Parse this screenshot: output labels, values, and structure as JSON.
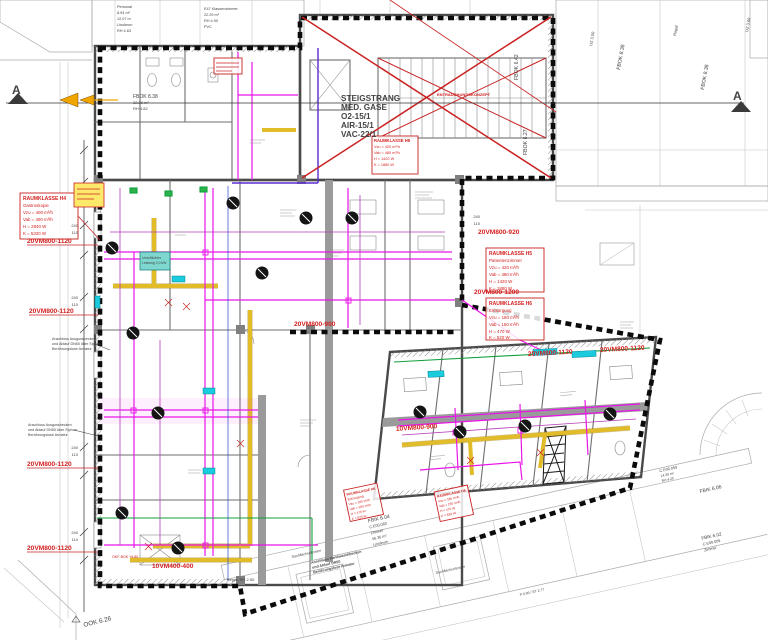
{
  "markers": {
    "section_left": "A",
    "section_right": "A"
  },
  "levels": {
    "ook": "OOK 6.26",
    "fbok_642": "FBOK 6.42",
    "fbok_627": "FBOK 6.27",
    "fbik_606": "FBIK 6.06",
    "fbok_838_b": "FBOK 8.38",
    "fbok_838_c": "FBOK 8.38"
  },
  "riser_note": {
    "l1": "STEIGSTRANG",
    "l2": "MED. GASE",
    "l3": "O2-15/1",
    "l4": "AIR-15/1",
    "l5": "VAC-22/1"
  },
  "crossed_note": "ENTRAUCHUNGSKONZEPT",
  "duct_labels": {
    "vm1": "20VM800-1120",
    "vm2": "20VM800-1120",
    "vm3": "20VM800-1120",
    "vm4": "20VM800-1120",
    "vm5": "20VM800-920",
    "vm6": "20VM800-1200",
    "vm7": "20VM800-900",
    "vm8": "20VM800-1120",
    "vm9": "20VM800-1120",
    "vm10": "10VM400-400",
    "vm11": "10VM800-900",
    "okf": "OKF-BOK +9.80"
  },
  "raumklasse_a": {
    "l1": "RAUMKLASSE H4",
    "l2": "Gastroskopie",
    "l3": "Vzu = 400 m³/h",
    "l4": "Vab = 400 m³/h",
    "l5": "H = 2840 W",
    "l6": "K = 5320 W"
  },
  "raumklasse_b": {
    "l1": "RAUMKLASSE H5",
    "l2": "Patientenzimmer",
    "l3": "Vzu = 420 m³/h",
    "l4": "Vab = 480 m³/h",
    "l5": "H = 1420 W",
    "l6": "K = 1880 W"
  },
  "raumklasse_c": {
    "l1": "RAUMKLASSE H6",
    "l2": "Entsorgung",
    "l3": "Vzu = 180 m³/h",
    "l4": "Vab = 150 m³/h",
    "l5": "H = 470 W",
    "l6": "K = 520 W"
  },
  "rooms": {
    "personal": {
      "l1": "Personal",
      "l2": "8.94 m²",
      "l3": "12.07 m",
      "l4": "Linoleum",
      "l5": "RH 4.63"
    },
    "klasse": {
      "l1": "E47 Klassenzimmer",
      "l2": "22.29 m²",
      "l3": "RH 4.90",
      "l4": "PVC"
    },
    "bath": {
      "l1": "FBOK 8.38",
      "l2": "32.29 m²",
      "l3": "RH 4.82"
    },
    "zimmer_b": {
      "l1": "FBIK 6.04",
      "l2": "C.E00.060",
      "l3": "Zimmer",
      "l4": "46.36 m²",
      "l5": "Linoleum"
    },
    "zimmer_r": {
      "l1": "FBIK 6.02",
      "l2": "C.E00.009",
      "l3": "Zimmer"
    },
    "wirtschaft": {
      "l1": "C.E00.059",
      "l2": "14.39 m²",
      "l3": "RH 4.20"
    },
    "regal": "Regal",
    "treppe": "Treppe RH 2.50",
    "stair_dim": "P 0.95 / ST 2.77"
  },
  "annotations": {
    "ausguss1": {
      "l1": "Anschluss Ausgussbecken",
      "l2": "und Ablauf DN50 über Siphon",
      "l3": "Berührungslose Armatur"
    },
    "ausguss2": {
      "l1": "Anschluss Ausgussbecken",
      "l2": "und Ablauf DN50 über Siphon",
      "l3": "Berührungslose Armatur"
    },
    "handwasch": {
      "l1": "Anschluss Handwaschbecken",
      "l2": "und Ablauf DN50",
      "l3": "Berührungslose Armatur"
    },
    "umluft": {
      "l1": "Umluftkühler",
      "l2": "Leistung 2,0 kW"
    },
    "dachfenster1": "Dachflächenfenster",
    "dachfenster2": "Dachflächenfenster"
  },
  "dims": {
    "d240": "240",
    "d110": "110",
    "uz1": "UZ 3.50",
    "uz2": "UZ 3.60"
  },
  "colors": {
    "annotation_red": "#d42020",
    "duct_magenta": "#e816e8",
    "duct_yellow": "#e2bc28",
    "hvac_cyan": "#19cbdc",
    "pipe_green": "#12a03c",
    "boundary_black": "#0b0b0b"
  }
}
